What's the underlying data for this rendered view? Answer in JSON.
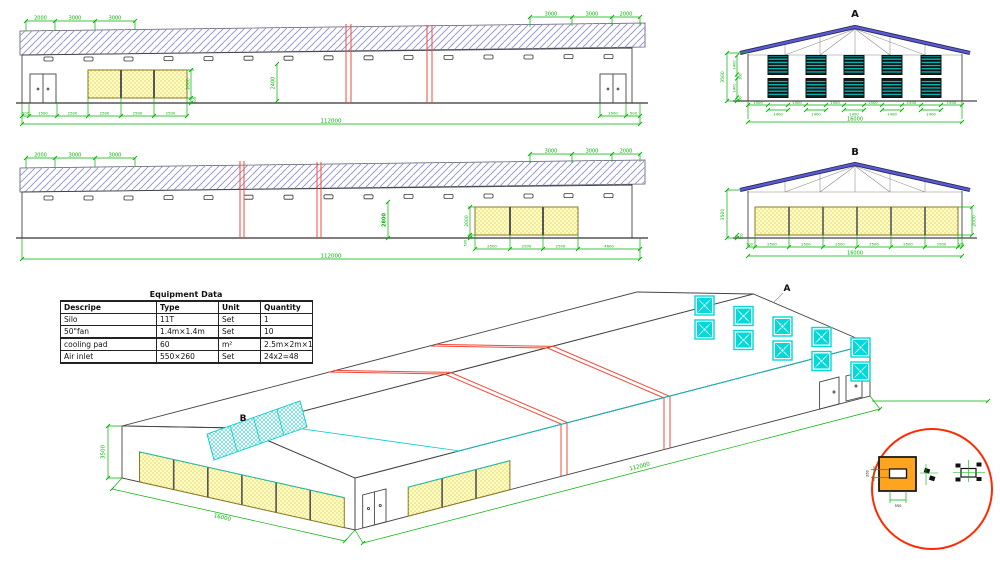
{
  "table": {
    "title": "Equipment Data",
    "headers": [
      "Descripe",
      "Type",
      "Unit",
      "Quantity"
    ],
    "rows": [
      [
        "Silo",
        "11T",
        "Set",
        "1"
      ],
      [
        "50\"fan",
        "1.4m×1.4m",
        "Set",
        "10"
      ],
      [
        "cooling pad",
        "60",
        "m²",
        "2.5m×2m×12"
      ],
      [
        "Air inlet",
        "550×260",
        "Set",
        "24x2=48"
      ]
    ]
  },
  "elev1": {
    "top": [
      "2000",
      "3000",
      "3000",
      "3000",
      "3000",
      "2000"
    ],
    "mid": "2400",
    "pad_h": "2000",
    "pad_sill": "500",
    "bottom": [
      "500",
      "1500",
      "2500",
      "2500",
      "2500",
      "2500"
    ],
    "bottom_r": [
      "1500",
      "500"
    ],
    "total": "112000"
  },
  "elev2": {
    "top": [
      "2000",
      "3000",
      "3000",
      "3000",
      "3000",
      "2000"
    ],
    "mid": "2800",
    "pad_h": "2000",
    "pad_sill": "500",
    "bottom": [
      "2500",
      "2500",
      "2500",
      "4600"
    ],
    "total": "112000"
  },
  "gableA": {
    "label": "A",
    "height": "3500",
    "left": [
      "1400",
      "300",
      "1400",
      "300"
    ],
    "gaps": [
      "1500",
      "1500",
      "1500",
      "1500",
      "1500",
      "1500"
    ],
    "fans": [
      "1400",
      "1400",
      "1400",
      "1400",
      "1400"
    ],
    "total": "16000"
  },
  "gableB": {
    "label": "B",
    "height": "3500",
    "sill": "300",
    "pad_h": "2000",
    "bottom": [
      "500",
      "2500",
      "2500",
      "2500",
      "2500",
      "2500",
      "2500",
      "500"
    ],
    "total": "16000"
  },
  "iso": {
    "label_a": "A",
    "label_b": "B",
    "height": "3500",
    "width": "16000",
    "length": "112000"
  },
  "detail": {
    "w": "550",
    "h": "260"
  }
}
